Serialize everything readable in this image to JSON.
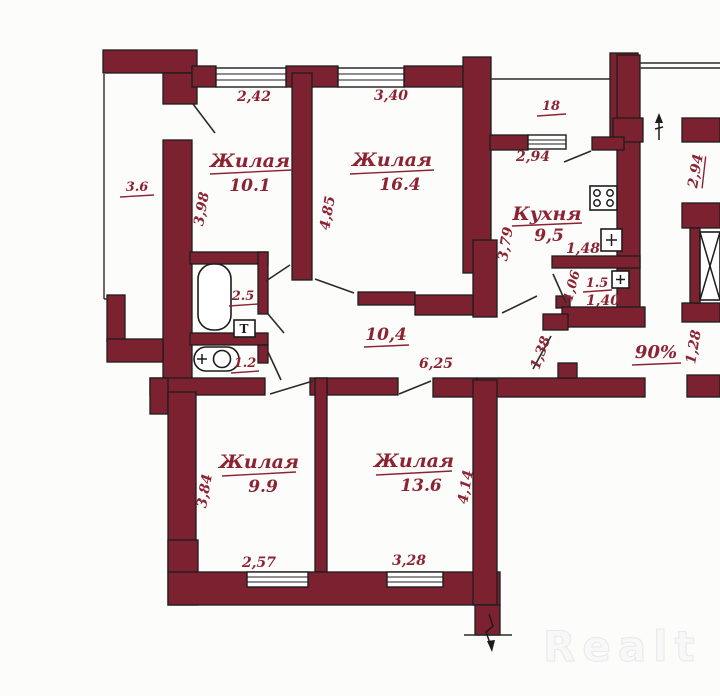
{
  "watermark": "Realt",
  "colors": {
    "wall": "#7b2130",
    "label": "#8c2333"
  },
  "rooms": {
    "room_10_1": {
      "name": "Жилая",
      "area": "10.1"
    },
    "room_16_4": {
      "name": "Жилая",
      "area": "16.4"
    },
    "kitchen": {
      "name": "Кухня",
      "area": "9,5"
    },
    "room_9_9": {
      "name": "Жилая",
      "area": "9.9"
    },
    "room_13_6": {
      "name": "Жилая",
      "area": "13.6"
    },
    "hall": {
      "area": "10,4"
    },
    "bathroom": {
      "area": "2.5"
    },
    "wc": {
      "area": "1.2"
    },
    "storage": {
      "area": "1.5"
    },
    "balcony_left": {
      "area": "3.6"
    },
    "balcony_top": {
      "area": "18"
    }
  },
  "dimensions": {
    "window_room1": "2,42",
    "window_room2": "3,40",
    "window_kitchen": "2,94",
    "room1_depth": "3,98",
    "room2_depth": "4,85",
    "kitchen_depth": "3,79",
    "kitchen_width": "1,48",
    "storage_height": "1,06",
    "storage_width": "1,40",
    "hall_length": "6,25",
    "entry_door": "1,38",
    "stair_bay": "2,94",
    "stair_width": "1,28",
    "ownership_share": "90%",
    "room3_depth": "3,84",
    "room3_width": "2,57",
    "room4_width": "3,28",
    "room4_depth": "4,14"
  },
  "fixtures": {
    "towel_rail": "T"
  }
}
